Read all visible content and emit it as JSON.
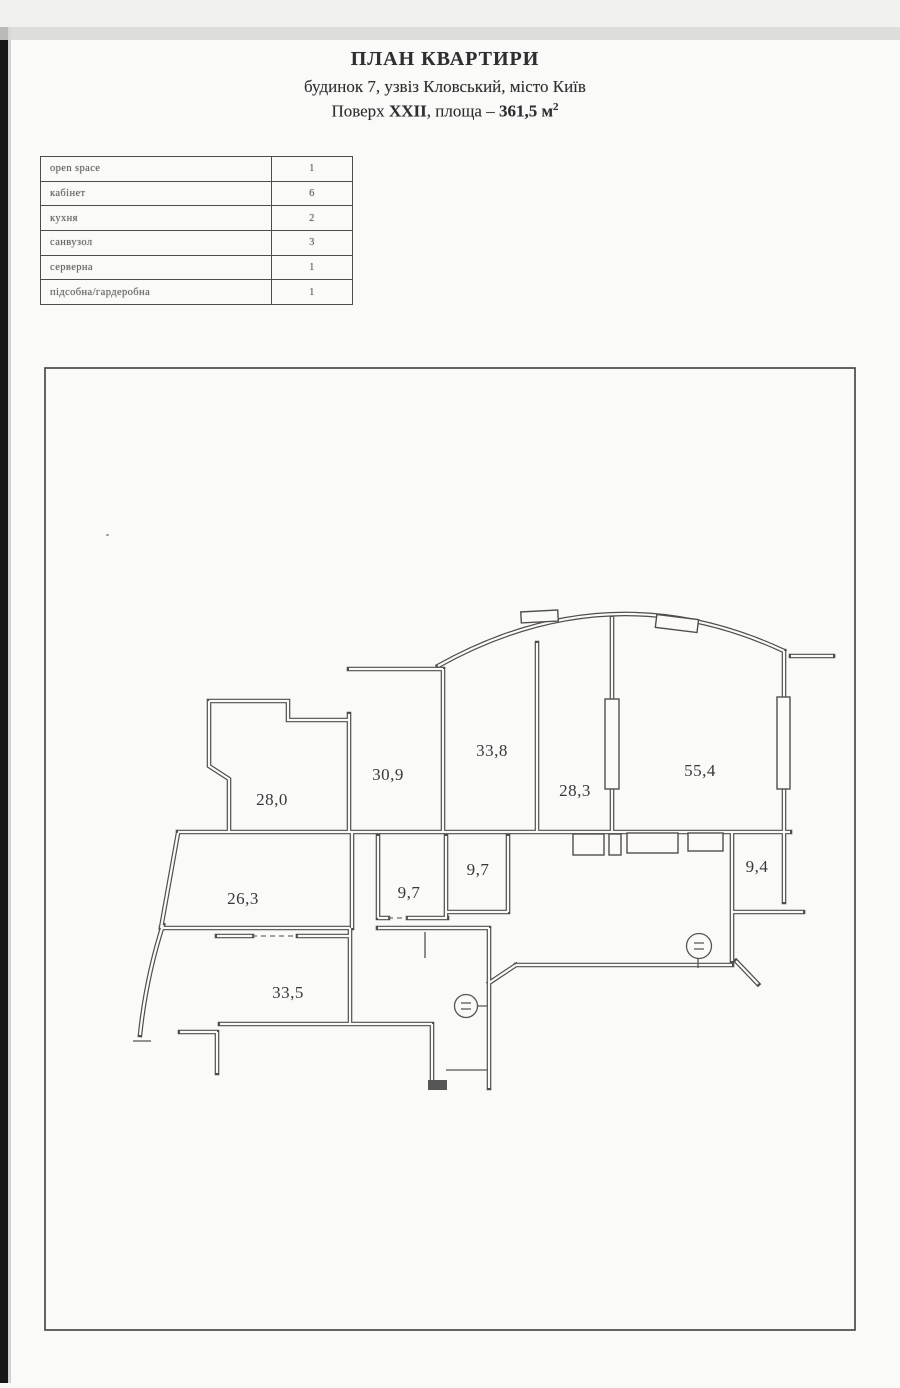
{
  "header": {
    "title": "ПЛАН КВАРТИРИ",
    "address_line": "будинок 7, узвіз Кловський, місто Київ",
    "floor_prefix": "Поверх ",
    "floor_value": "XXII",
    "area_mid": ", площа – ",
    "area_value": "361,5 м",
    "area_sup": "2"
  },
  "room_table": {
    "rows": [
      {
        "label": "open space",
        "count": "1"
      },
      {
        "label": "кабінет",
        "count": "6"
      },
      {
        "label": "кухня",
        "count": "2"
      },
      {
        "label": "санвузол",
        "count": "3"
      },
      {
        "label": "серверна",
        "count": "1"
      },
      {
        "label": "підсобна/гардеробна",
        "count": "1"
      }
    ]
  },
  "floor_plan": {
    "rooms": [
      {
        "area": "28,0"
      },
      {
        "area": "30,9"
      },
      {
        "area": "33,8"
      },
      {
        "area": "28,3"
      },
      {
        "area": "55,4"
      },
      {
        "area": "26,3"
      },
      {
        "area": "9,7"
      },
      {
        "area": "9,7"
      },
      {
        "area": "9,4"
      },
      {
        "area": "33,5"
      }
    ]
  }
}
